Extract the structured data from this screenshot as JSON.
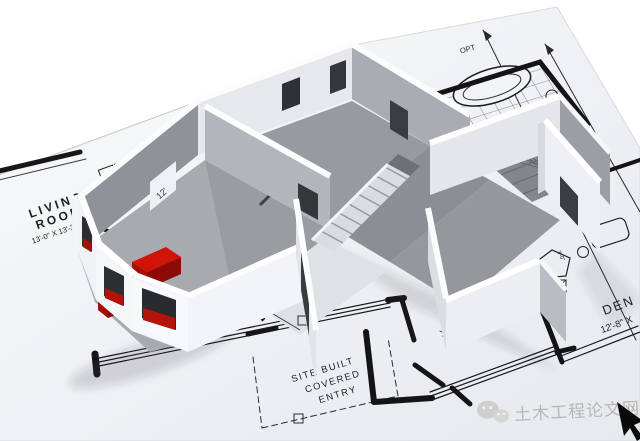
{
  "scene": {
    "description": "3D rendered wall model standing on an architectural blueprint floor plan",
    "colors": {
      "paper": "#eef0f3",
      "ink": "#1f1f23",
      "wall_light": "#eceef1",
      "wall_dark": "#8f9298",
      "floor": "#979aa0",
      "sofa_red": "#c41208",
      "watermark_gray": "#b7b7b4"
    },
    "blueprint": {
      "dim_top": "51'-4\"",
      "opt": "OPT",
      "living1": "LIVING",
      "living2": "ROOM",
      "living_size": "13'-0\" X 13'-3\"",
      "china": "CHINA",
      "dw": "DW",
      "oven": "OVEN",
      "twelve": "12'",
      "bath": "BA 1",
      "foy": "FOY",
      "den": "DEN",
      "den_size": "12'-8\" X",
      "size13": "X 13'-0\"",
      "dim36": "36",
      "closet_a": "3'-0\"",
      "closet_b": "3'-0\"",
      "entry1": "SITE BUILT",
      "entry2": "COVERED",
      "entry3": "ENTRY"
    },
    "watermark": {
      "text": "土木工程论文网",
      "icon": "wechat-chat-bubbles"
    }
  }
}
